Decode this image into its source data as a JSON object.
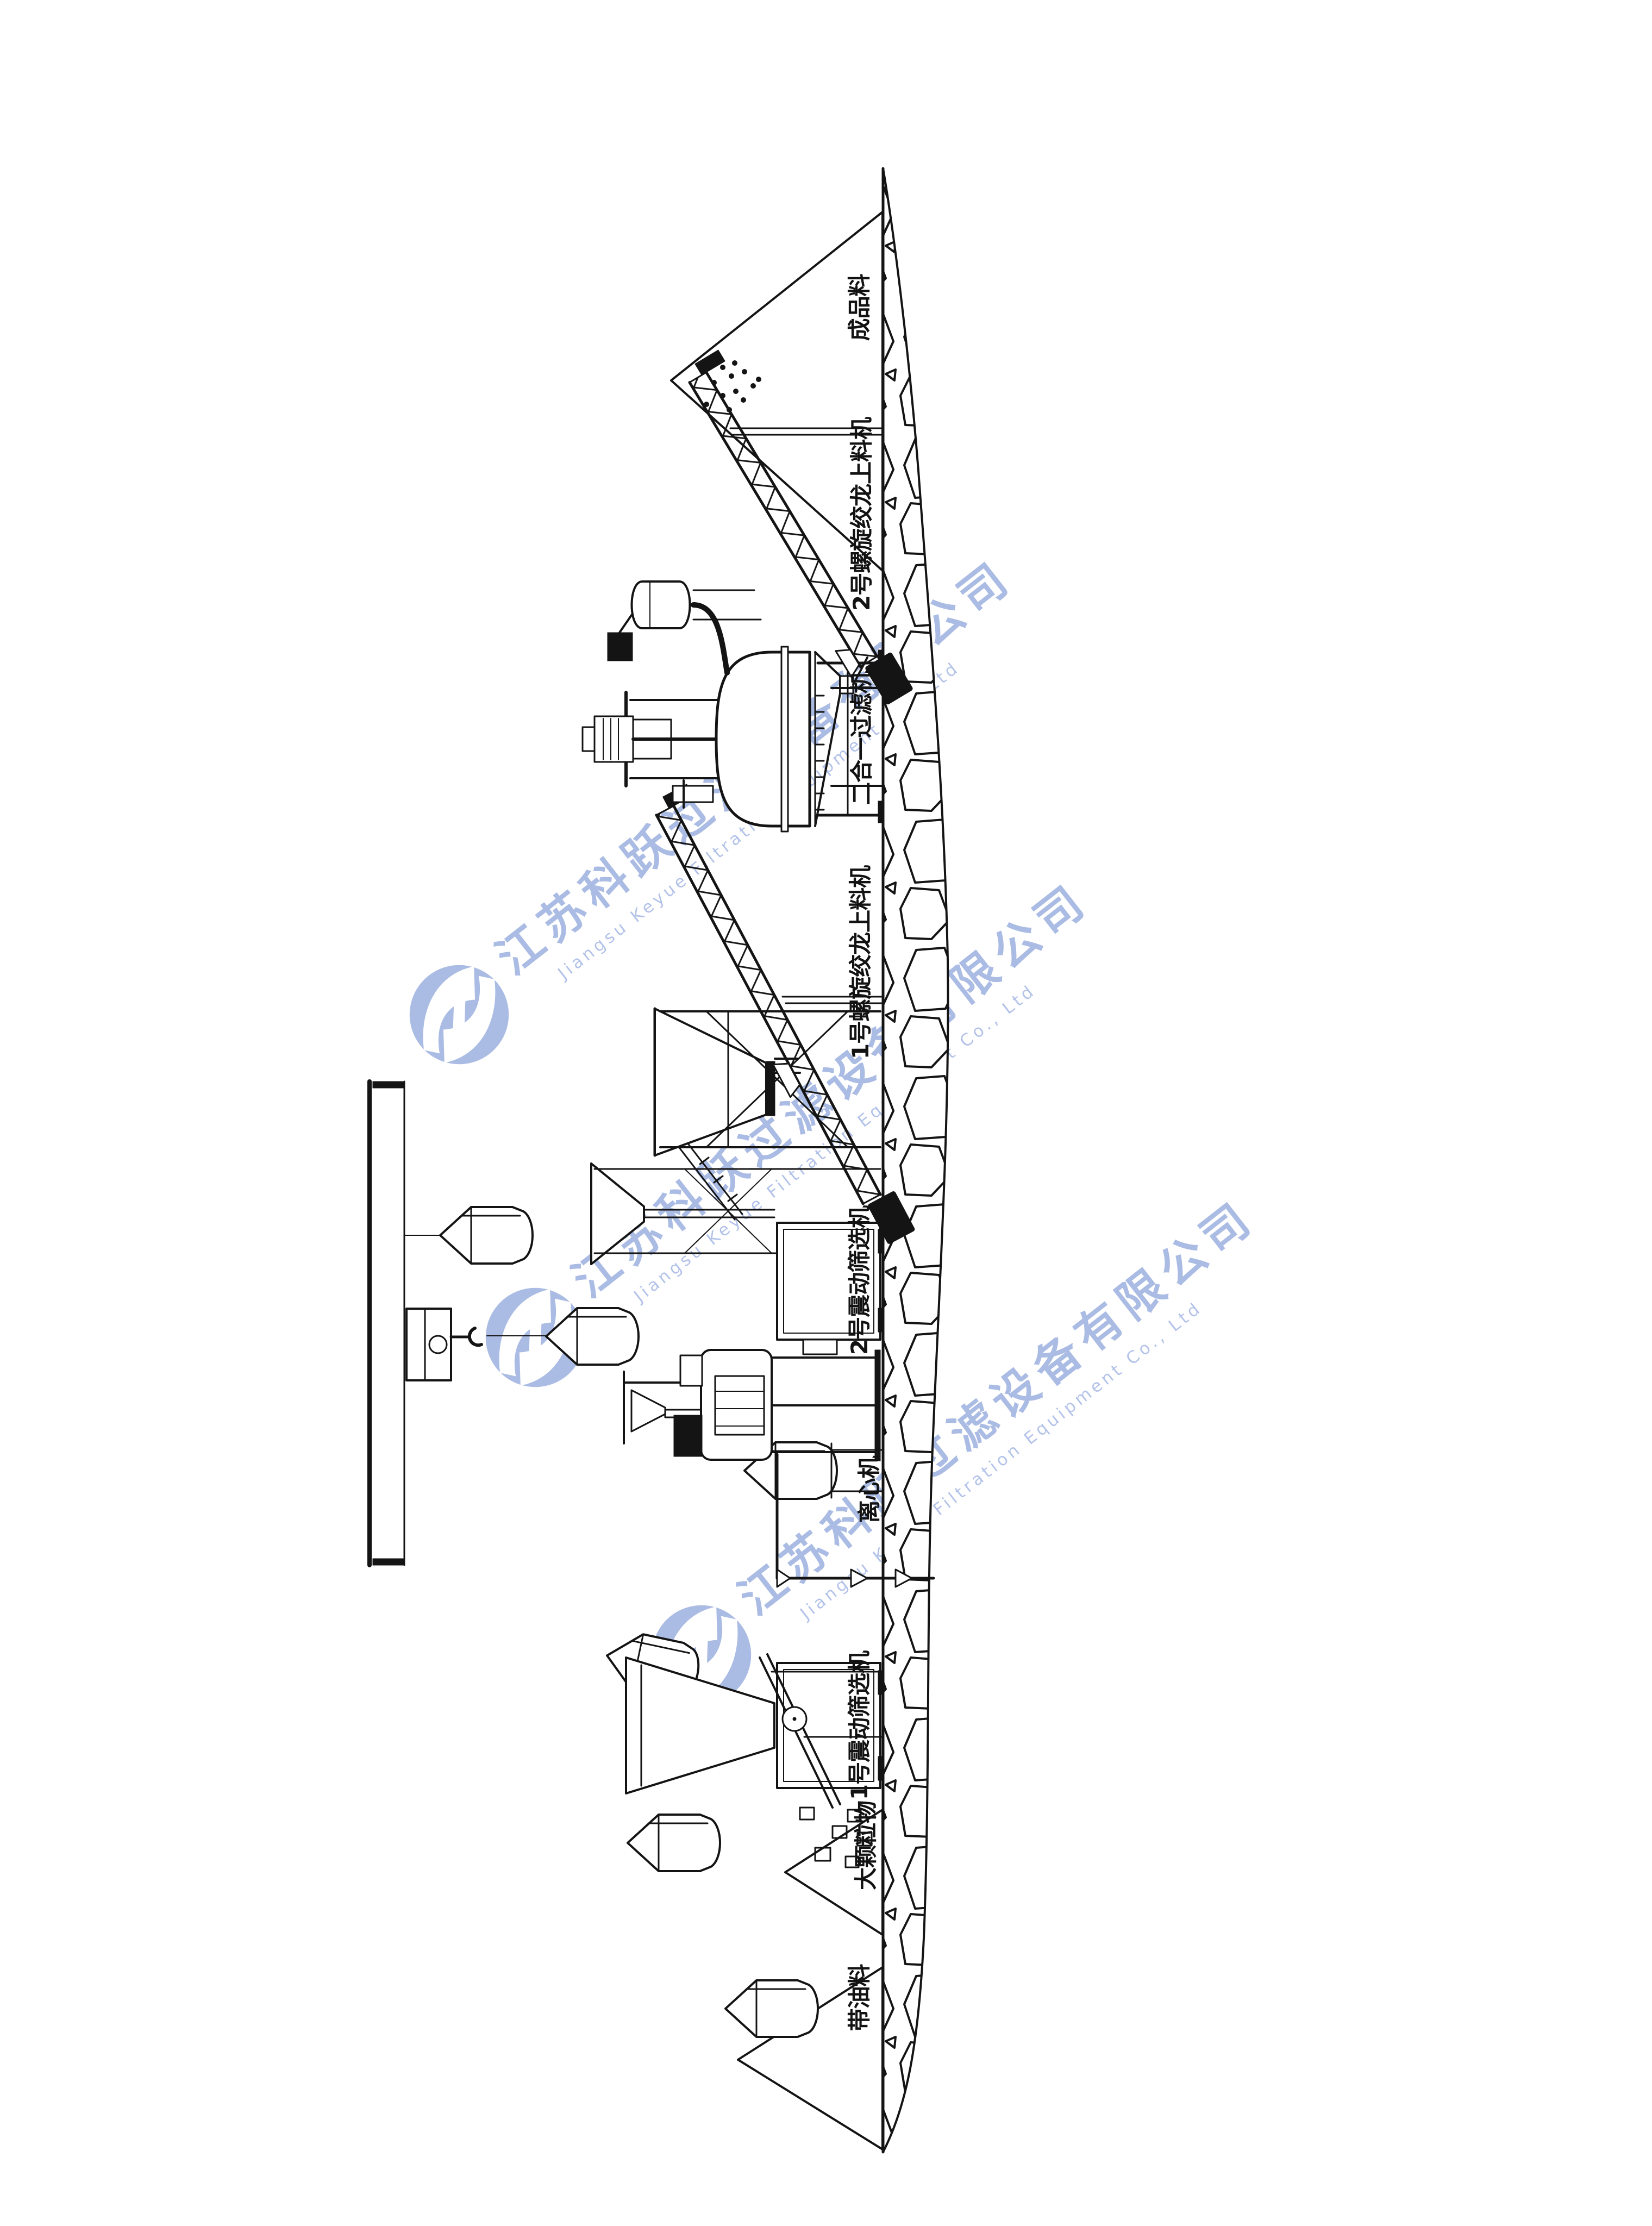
{
  "watermark": {
    "cn": "江苏科跃过滤设备有限公司",
    "en": "Jiangsu Keyue Filtration Equipment Co., Ltd",
    "color_cn": "#9db1e0",
    "color_en": "#a6b8e6",
    "logo": "keyue-swoosh-circle-logo"
  },
  "drawing": {
    "line_color": "#141414",
    "background": "#ffffff",
    "labels": {
      "finished_pile": "成品料",
      "screw_feeder_2": "2号螺旋绞龙上料机",
      "filter": "二合一过滤机",
      "screw_feeder_1": "1号螺旋绞龙上料机",
      "screen_2": "2号震动筛选机",
      "centrifuge": "离心机",
      "screen_1": "1号震动筛选机",
      "coarse_pile": "大颗粒物",
      "oily_pile": "带油料"
    }
  }
}
